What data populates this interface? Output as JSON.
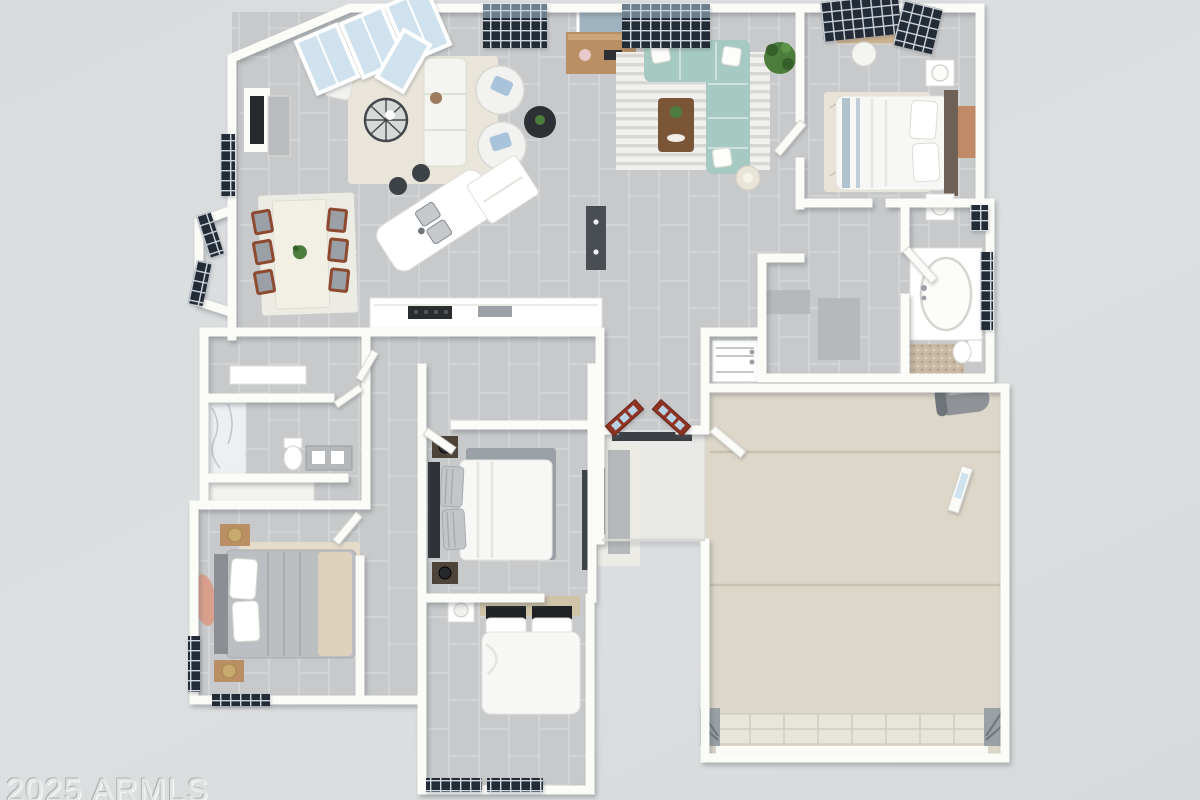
{
  "watermark": {
    "text": "2025 ARMLS"
  },
  "scene": {
    "type": "3d-floor-plan-top-view",
    "rooms": [
      "flex-room",
      "dining-area",
      "sitting-area",
      "kitchen",
      "great-room",
      "primary-bedroom",
      "primary-bathroom",
      "hall",
      "bathroom-2",
      "laundry",
      "bedroom-2",
      "bedroom-3",
      "bedroom-4",
      "entry-porch",
      "garage"
    ]
  },
  "colors": {
    "background": "#dbdee0",
    "wall": "#fbfbf8",
    "wall_shade": "#ecebe6",
    "white": "#ffffff",
    "floor_tile": "#c7c9ca",
    "tile_grout": "#d2d4d5",
    "garage_floor": "#ddd7c9",
    "garage_joint": "#c8c1b0",
    "porch": "#e9e9e7",
    "window_frame": "#232b37",
    "window_glass": "#b9d3e6",
    "glass_panel": "#cfe2ee",
    "sofa": "#a6cac1",
    "rug_cream": "#e9e5da",
    "rug_gray": "#9aa0a6",
    "wood": "#b98f63",
    "wood_dark": "#7a5636",
    "chair_wood": "#8d4a30",
    "door_red": "#8e3322",
    "appliance": "#494e54",
    "black": "#26292c",
    "duvet": "#f7f7f5",
    "gray_bed": "#bcbfc1",
    "headboard_dark": "#6f6156",
    "tan_accent": "#c08a66",
    "blush": "#d8a08c",
    "plant": "#4c7d3c",
    "pebble": "#c9b9a4",
    "marble": "#edeff1",
    "metal": "#8f9397",
    "carpet": "#b6b9bb"
  }
}
